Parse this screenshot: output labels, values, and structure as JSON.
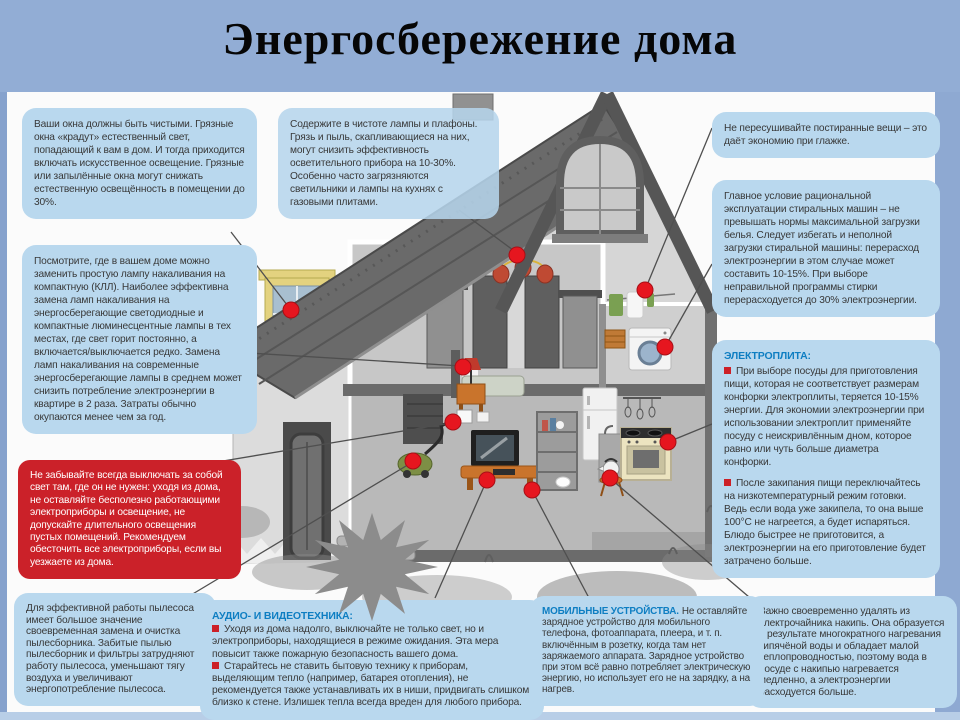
{
  "slide": {
    "title": "Энергосбережение дома"
  },
  "colors": {
    "band_blue": "#92add5",
    "bubble_blue": "#b9d8ee",
    "red_box": "#cb2129",
    "header_blue": "#0e7ec2",
    "callout_dot_red": "#e6161f"
  },
  "callouts": {
    "windows": {
      "text": "Ваши окна должны быть чистыми. Грязные окна «крадут» естественный свет, попадающий к вам в дом. И тогда приходится включать искусственное освещение. Грязные или запылённые окна могут снижать естественную освещённость в помещении до 30%."
    },
    "lamp_replacement": {
      "text": "Посмотрите, где в вашем доме можно заменить простую лампу накаливания на компактную (КЛЛ). Наиболее эффективна замена ламп накаливания на энергосберегающие светодиодные и компактные люминесцентные лампы в тех местах, где свет горит постоянно, а включается/выключается редко. Замена ламп накаливания на современные энергосберегающие лампы в среднем может снизить потребление электроэнергии в квартире в 2 раза. Затраты обычно окупаются менее чем за год."
    },
    "turn_off_lights": {
      "text": "Не забывайте всегда выключать за собой свет там, где он не нужен: уходя из дома, не оставляйте бесполезно работающими электроприборы и освещение, не допускайте длительного освещения пустых помещений. Рекомендуем обесточить все электроприборы, если вы уезжаете из дома."
    },
    "vacuum_cleaner": {
      "text": "Для эффективной работы пылесоса имеет большое значение своевременная замена и очистка пылесборника. Забитые пылью пылесборник и фильтры затрудняют работу пылесоса, уменьшают тягу воздуха и увеличивают энергопотребление пылесоса."
    },
    "lamp_shades": {
      "text": "Содержите в чистоте лампы и плафоны. Грязь и пыль, скапливающиеся на них, могут снизить эффективность осветительного прибора на 10-30%. Особенно часто загрязняются светильники и лампы на кухнях с газовыми плитами."
    },
    "laundry_drying": {
      "text": "Не пересушивайте постиранные вещи – это даёт экономию при глажке."
    },
    "washing_machine": {
      "text": "Главное условие рациональной эксплуатации стиральных машин – не превышать нормы максимальной загрузки белья. Следует избегать и неполной загрузки стиральной машины: перерасход электроэнергии в этом случае может составить 10-15%. При выборе неправильной программы стирки перерасходуется до 30% электроэнергии."
    },
    "electric_stove": {
      "header": "ЭЛЕКТРОПЛИТА:",
      "bullet1": "При выборе посуды для приготовления пищи, которая не соответствует размерам конфорки электроплиты, теряется 10-15% энергии. Для экономии электроэнергии при использовании электроплит применяйте посуду с неискривлённым дном, которое равно или чуть больше диаметра конфорки.",
      "bullet2": "После закипания пищи переключайтесь на низкотемпературный режим готовки. Ведь если вода уже закипела, то она выше 100°С не нагреется, а будет испаряться. Блюдо быстрее не приготовится, а электроэнергии на его приготовление будет затрачено больше."
    },
    "electric_kettle": {
      "text": "Важно своевременно удалять из электрочайника накипь. Она образуется в результате многократного нагревания кипячёной воды и обладает малой теплопроводностью, поэтому вода в посуде с накипью нагревается медленно, а электроэнергии расходуется больше."
    },
    "audio_video": {
      "header": "АУДИО- И ВИДЕОТЕХНИКА:",
      "bullet1": "Уходя из дома надолго, выключайте не только свет, но и электроприборы, находящиеся в режиме ожидания. Эта мера повысит также пожарную безопасность вашего дома.",
      "bullet2": "Старайтесь не ставить бытовую технику к приборам, выделяющим тепло (например, батарея отопления), не рекомендуется также устанавливать их в ниши, придвигать слишком близко к стене. Излишек тепла всегда вреден для любого прибора."
    },
    "mobile_devices": {
      "header": "МОБИЛЬНЫЕ УСТРОЙСТВА.",
      "text": "Не оставляйте зарядное устройство для мобильного телефона, фотоаппарата, плеера, и т. п. включённым в розетку, когда там нет заряжаемого аппарата. Зарядное устройство при этом всё равно потребляет электрическую энергию, но использует его не на зарядку, а на нагрев."
    }
  }
}
